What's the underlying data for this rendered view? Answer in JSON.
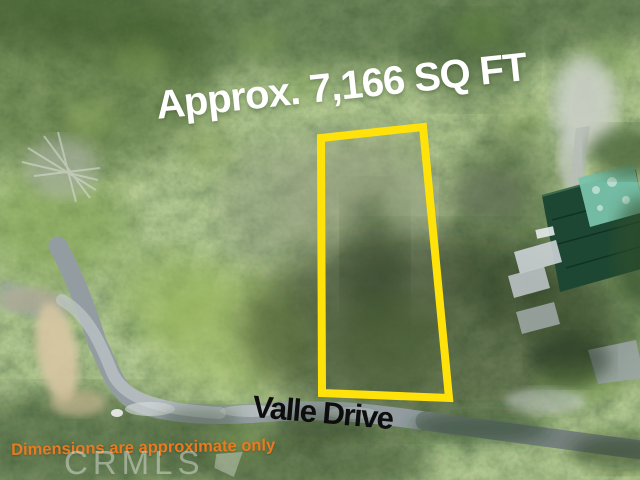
{
  "scene": {
    "type": "aerial-photo",
    "subject": "Wooded residential lot outlined in yellow beside Valle Drive"
  },
  "annotations": {
    "area_label": "Approx. 7,166 SQ FT",
    "street_label": "Valle Drive",
    "disclaimer": "Dimensions are approximate only",
    "watermark": "CRMLS"
  },
  "lot": {
    "boundary_points": "321,138 423,127 449,398 322,393"
  },
  "colors": {
    "lot-outline": "#ffe20a",
    "area-label-color": "#ffffff",
    "street-label-color": "#0d0d0d",
    "disclaimer-color": "#e87b20",
    "watermark-color": "rgba(240,244,240,0.42)"
  }
}
